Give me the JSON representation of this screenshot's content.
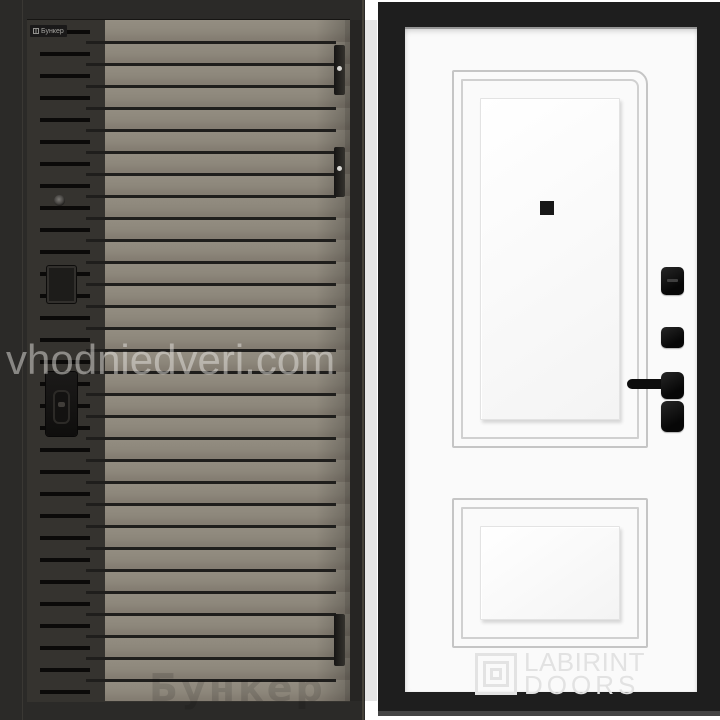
{
  "page": {
    "background_color": "#ffffff"
  },
  "watermark": {
    "site_text": "vhodniedveri.com"
  },
  "left_door": {
    "brand_badge": {
      "label": "Бункер",
      "icon": "grid-logo-icon"
    },
    "ghost_brand_text": "Бункер",
    "colors": {
      "frame": "#2b2a28",
      "strip": "#35332f",
      "insert": "#8b8578",
      "groove": "#1f1e1c"
    },
    "hinges_count": 3
  },
  "right_door": {
    "logo": {
      "line1": "LABIRINT",
      "line2": "DOORS",
      "icon": "labyrinth-maze-icon"
    },
    "colors": {
      "frame": "#1e1e1e",
      "face": "#fafafa",
      "molding": "#c5c5c5",
      "hardware": "#0d0d0d"
    },
    "panels_count": 2,
    "lock_blocks_count": 4
  }
}
